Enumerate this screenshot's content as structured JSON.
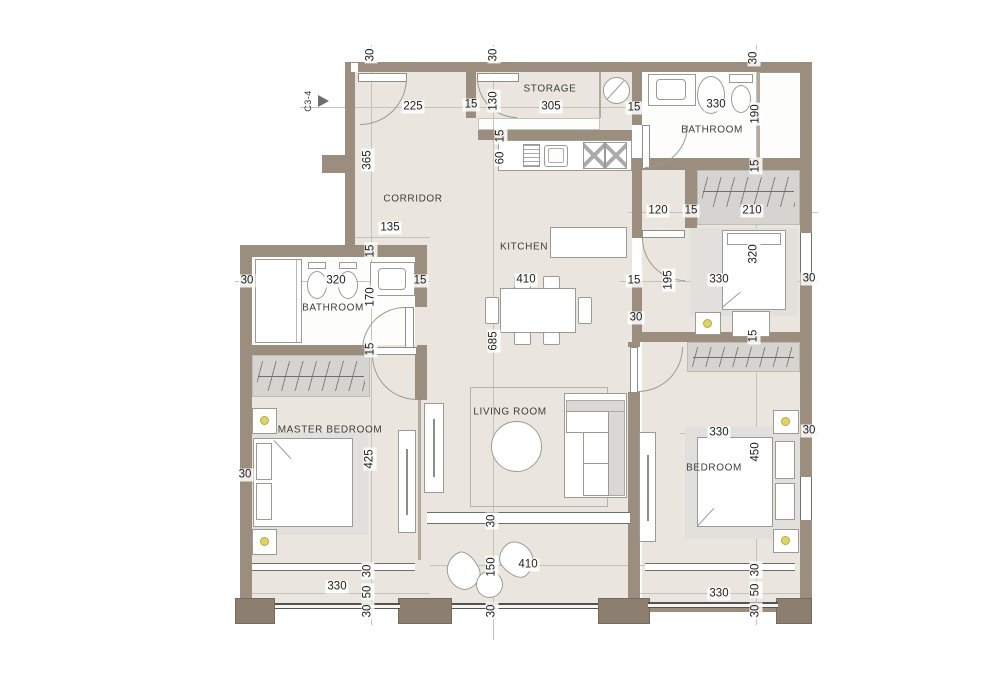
{
  "meta": {
    "unit": "C3-4"
  },
  "rooms": {
    "corridor": "CORRIDOR",
    "storage": "STORAGE",
    "kitchen": "KITCHEN",
    "bathroom_top": "BATHROOM",
    "bathroom_left": "BATHROOM",
    "living_room": "LIVING ROOM",
    "master_bedroom": "MASTER BEDROOM",
    "bedroom": "BEDROOM"
  },
  "dims": {
    "t30a": "30",
    "t225": "225",
    "t15a": "15",
    "t130": "130",
    "t30b": "30",
    "t305": "305",
    "t15b": "15",
    "t330": "330",
    "t190": "190",
    "t30c": "30",
    "l365": "365",
    "l135": "135",
    "lb30": "30",
    "lb320": "320",
    "lb15": "15",
    "lb170": "170",
    "lb15t": "15",
    "lb15b": "15",
    "k15": "15",
    "k60": "60",
    "k410": "410",
    "k685": "685",
    "r120": "120",
    "r15a": "15",
    "r210": "210",
    "r15b": "15",
    "r15c": "15",
    "r195": "195",
    "r330": "330",
    "r320": "320",
    "r30a": "30",
    "r30b": "30",
    "r15d": "15",
    "m425": "425",
    "m30": "30",
    "m330": "330",
    "m30a": "30",
    "m50": "50",
    "m30b": "30",
    "v30a": "30",
    "v150": "150",
    "v410": "410",
    "v30b": "30",
    "b330a": "330",
    "b450": "450",
    "b30a": "30",
    "b330b": "330",
    "b30m": "30",
    "b50": "50",
    "b30c": "30"
  }
}
